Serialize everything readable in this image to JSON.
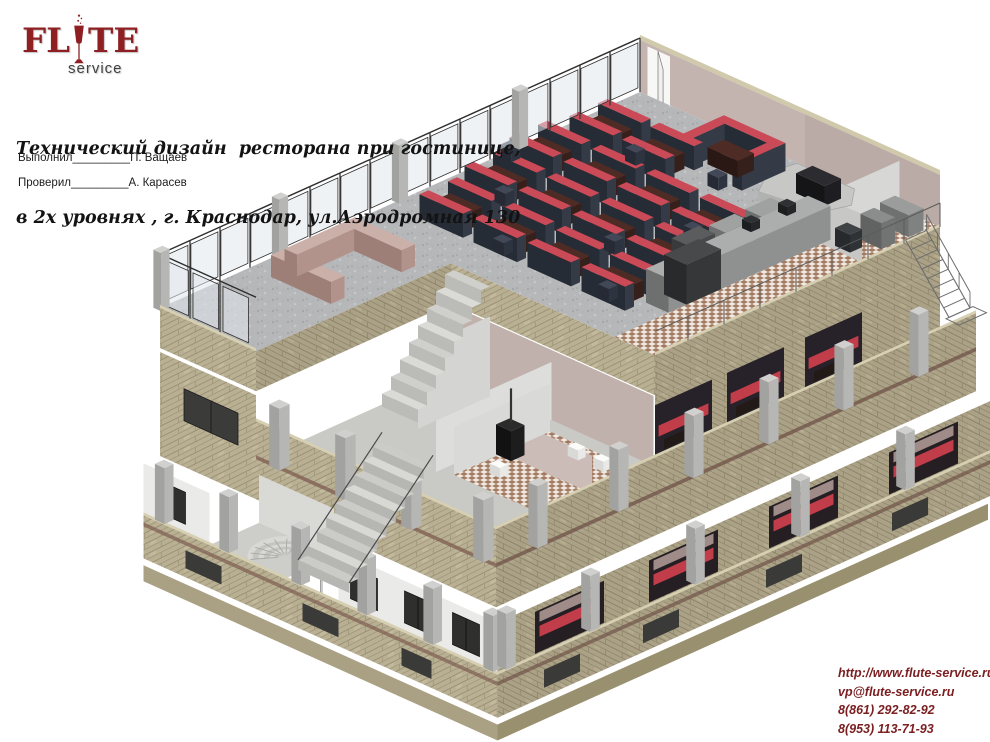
{
  "logo": {
    "brand_left": "FL",
    "brand_right": "TE",
    "subtitle": "service"
  },
  "title": {
    "line1": "Технический дизайн  ресторана при гостинице,",
    "line2": "в 2х уровнях , г. Краснодар, ул.Аэродромная 130"
  },
  "approvals": [
    {
      "label": "Выполнил",
      "line": "_________",
      "name": "П. Ващаев"
    },
    {
      "label": "Проверил",
      "line": "_________",
      "name": "А. Карасев"
    }
  ],
  "contacts": {
    "website": "http://www.flute-service.ru",
    "email": "vp@flute-service.ru",
    "phone_primary": "8(861) 292-82-92",
    "phone_secondary": "8(953) 113-71-93"
  },
  "colors": {
    "brand_red": "#8e2023",
    "contact_red": "#7b2022",
    "stone_beige": "#b9b094",
    "booth_red": "#ca4a57",
    "booth_dark": "#343b47"
  }
}
